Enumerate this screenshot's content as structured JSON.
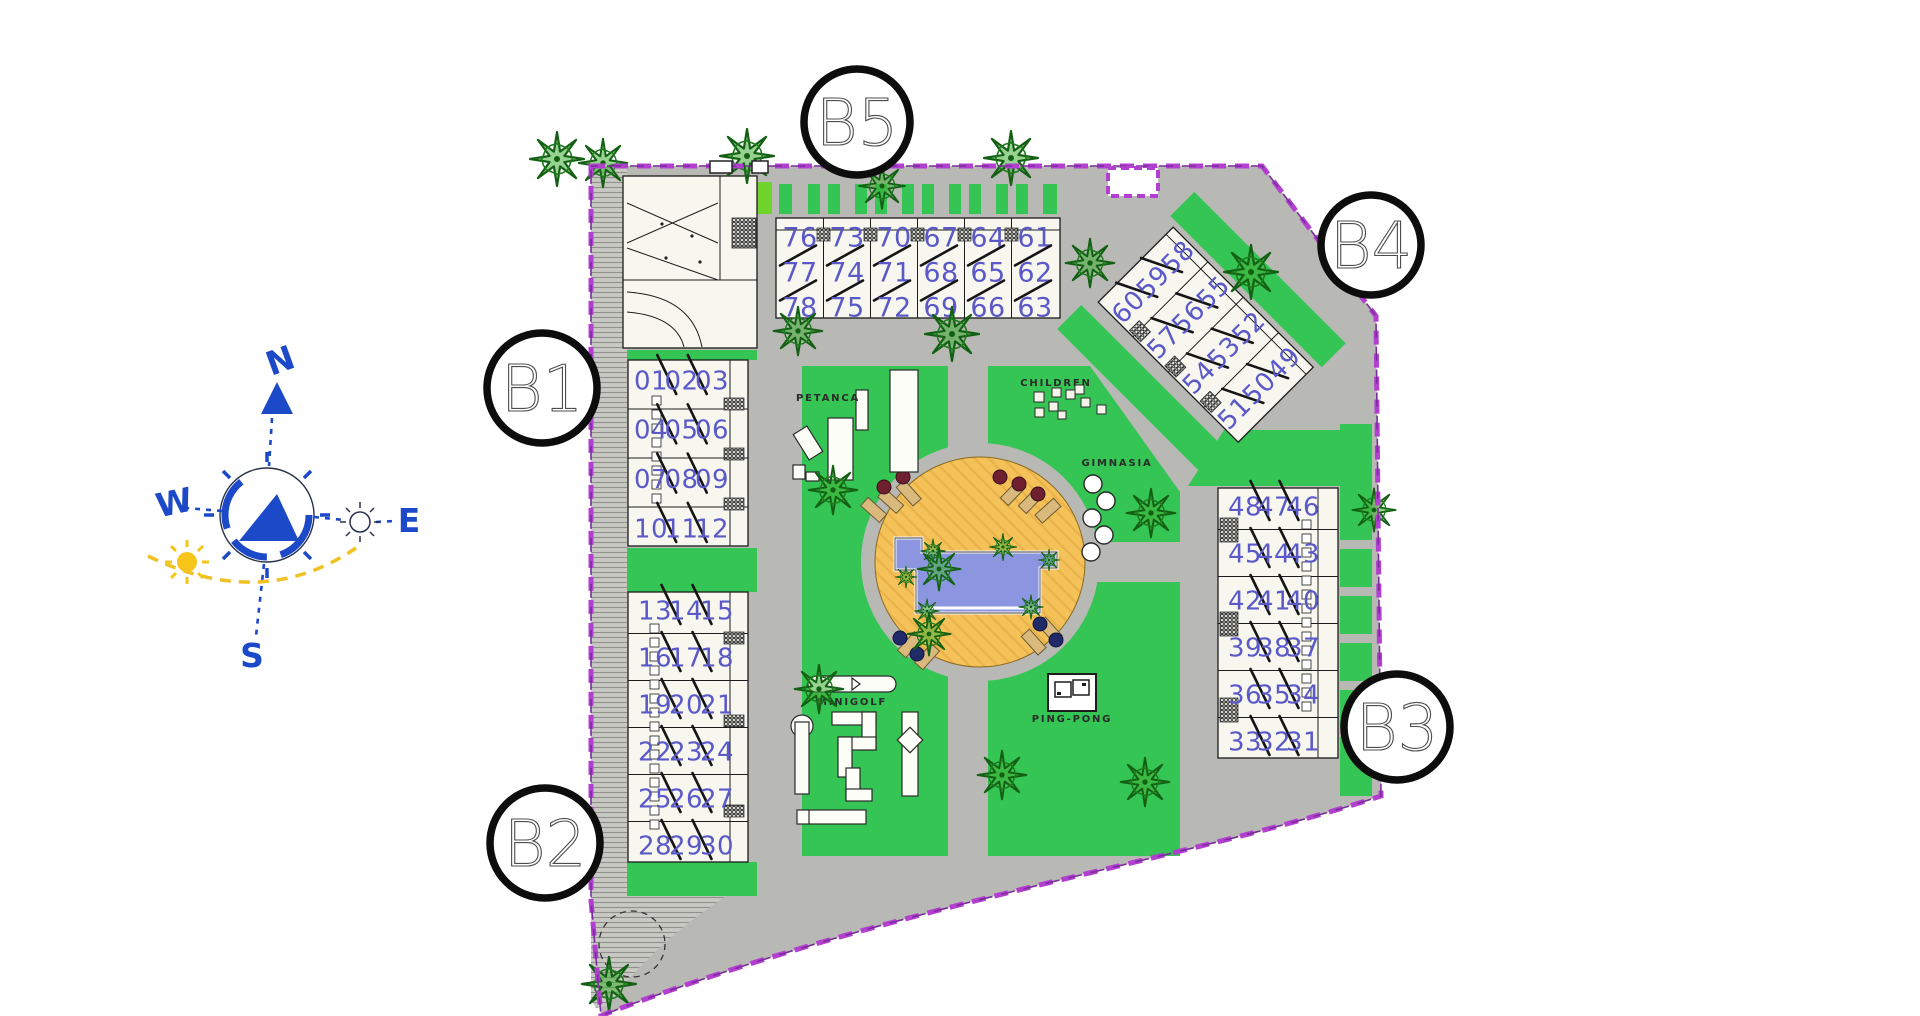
{
  "legend": {
    "petanca": "PETANCA",
    "children": "CHILDREN",
    "gimnasia": "GIMNASIA",
    "minigolf": "MINIGOLF",
    "pingpong": "PING-PONG"
  },
  "compass": {
    "north": "N",
    "east": "E",
    "south": "S",
    "west": "W"
  },
  "badges": {
    "b1": "B1",
    "b2": "B2",
    "b3": "B3",
    "b4": "B4",
    "b5": "B5"
  },
  "blocks": {
    "b1": [
      [
        "01",
        "02",
        "03"
      ],
      [
        "04",
        "05",
        "06"
      ],
      [
        "07",
        "08",
        "09"
      ],
      [
        "10",
        "11",
        "12"
      ]
    ],
    "b2": [
      [
        "13",
        "14",
        "15"
      ],
      [
        "16",
        "17",
        "18"
      ],
      [
        "19",
        "20",
        "21"
      ],
      [
        "22",
        "23",
        "24"
      ],
      [
        "25",
        "26",
        "27"
      ],
      [
        "28",
        "29",
        "30"
      ]
    ],
    "b3": [
      [
        "48",
        "47",
        "46"
      ],
      [
        "45",
        "44",
        "43"
      ],
      [
        "42",
        "41",
        "40"
      ],
      [
        "39",
        "38",
        "37"
      ],
      [
        "36",
        "35",
        "34"
      ],
      [
        "33",
        "32",
        "31"
      ]
    ],
    "b4": [
      [
        "60",
        "59",
        "58"
      ],
      [
        "57",
        "56",
        "55"
      ],
      [
        "54",
        "53",
        "52"
      ],
      [
        "51",
        "50",
        "49"
      ]
    ],
    "b5": [
      [
        "76",
        "77",
        "78"
      ],
      [
        "73",
        "74",
        "75"
      ],
      [
        "70",
        "71",
        "72"
      ],
      [
        "67",
        "68",
        "69"
      ],
      [
        "64",
        "65",
        "66"
      ],
      [
        "61",
        "62",
        "63"
      ]
    ]
  },
  "colors": {
    "boundary": "#b33fd1",
    "lawn": "#35c554",
    "lawn_light": "#70d42c",
    "road": "#b8b8b4",
    "unit_number": "#5b59c8",
    "pool_water": "#8b95e0",
    "pool_deck": "#f5c25a",
    "compass_blue": "#1c49c8"
  }
}
